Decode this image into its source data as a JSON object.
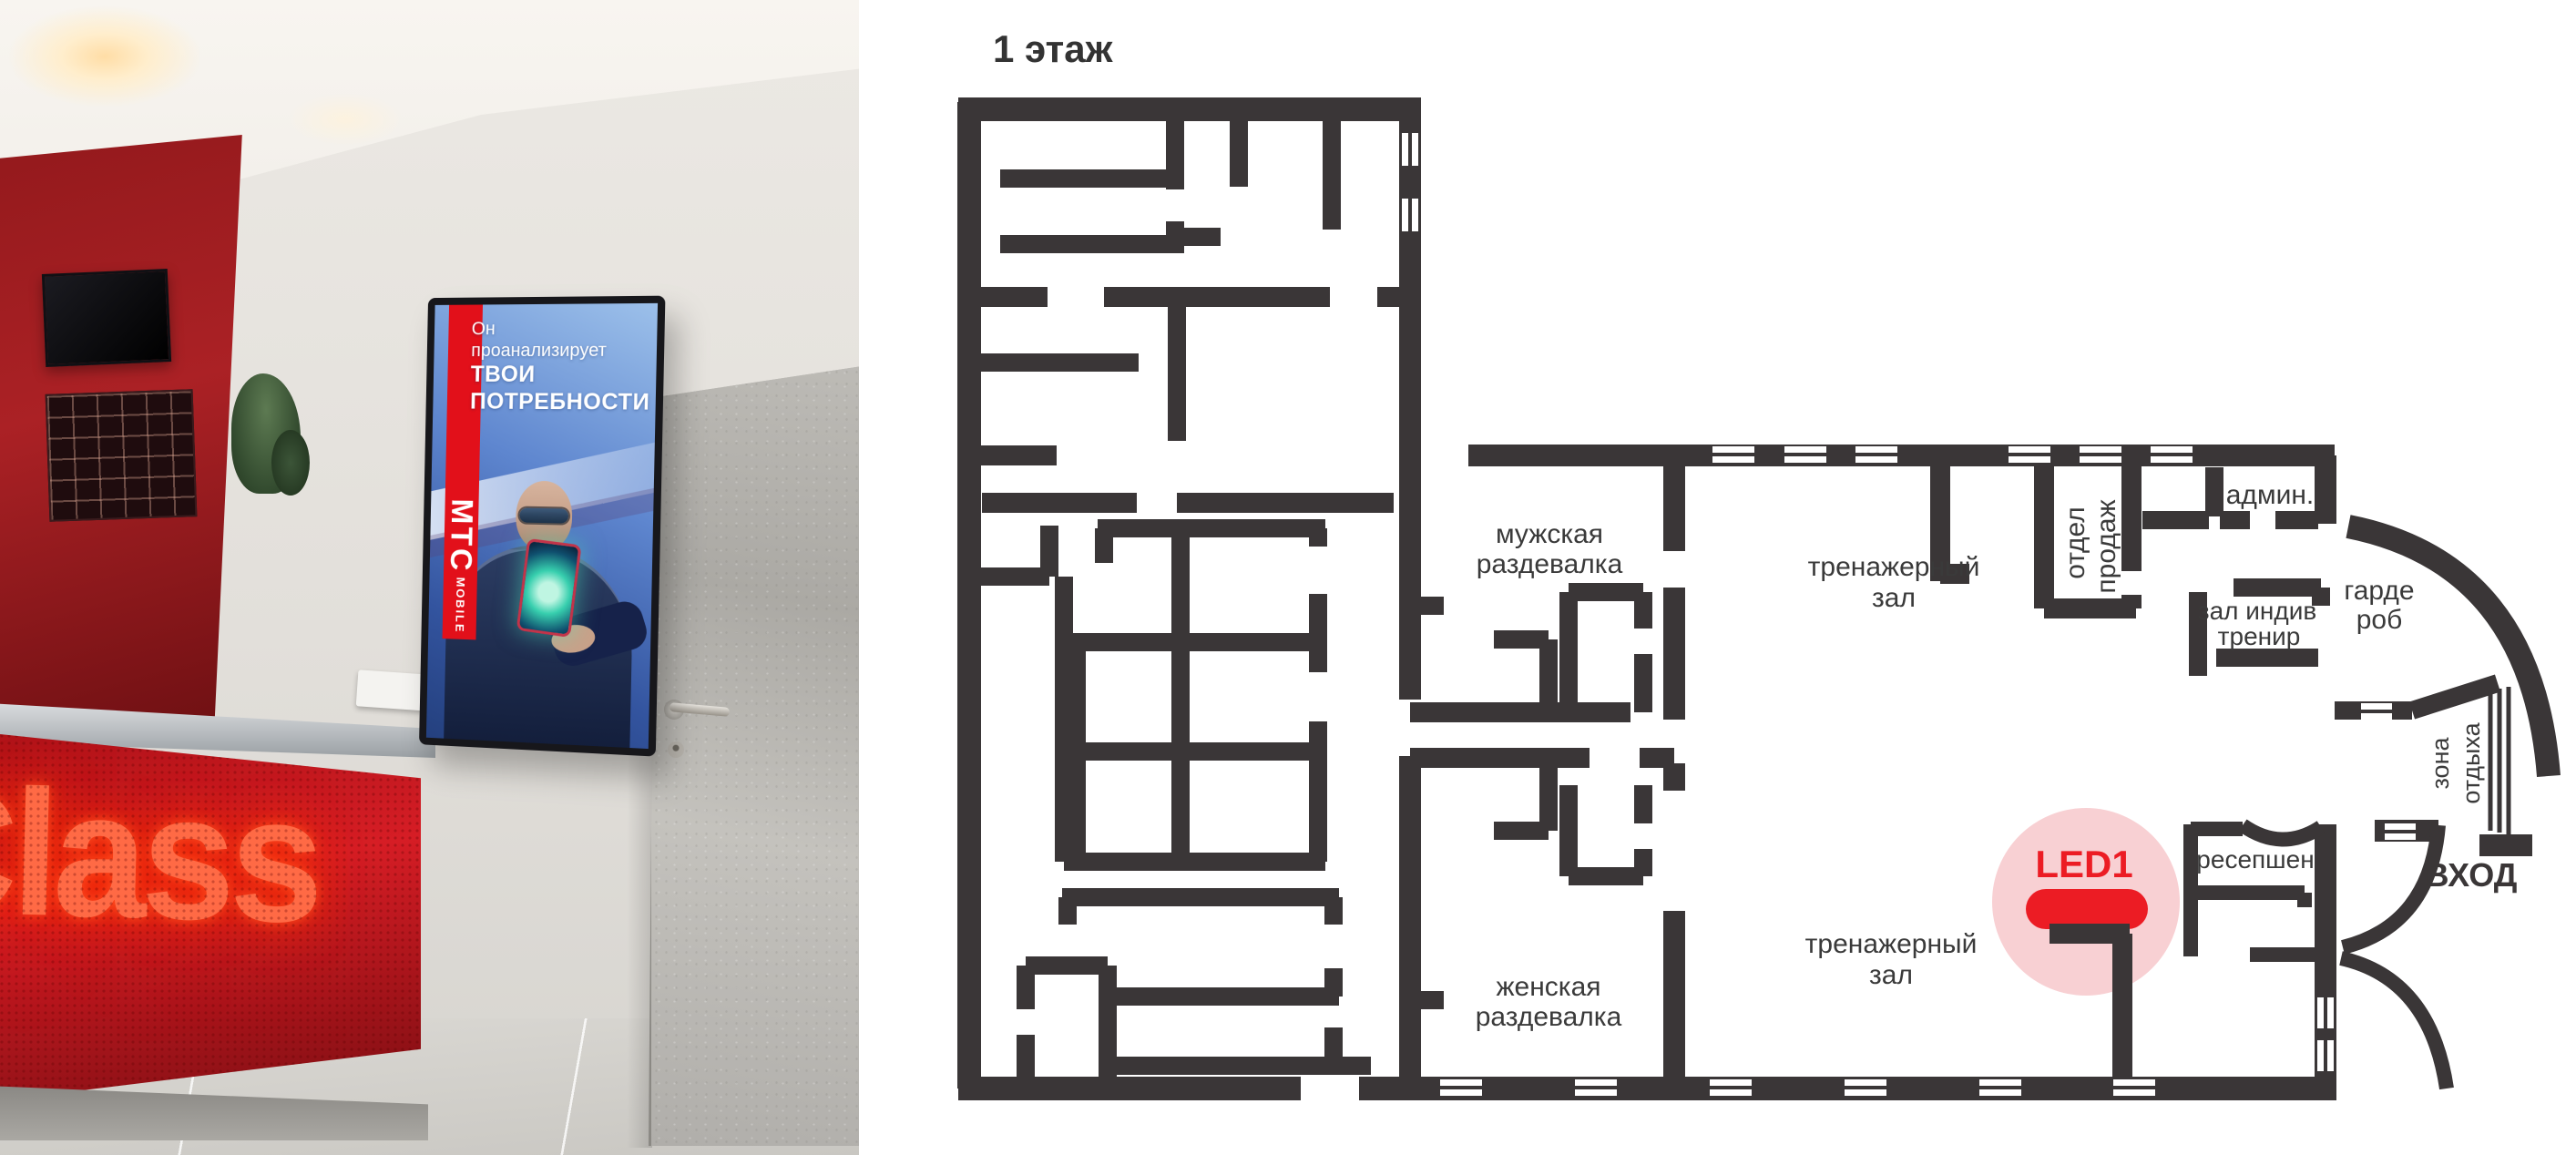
{
  "floorplan": {
    "title": "1 этаж",
    "wall_color": "#3a3637",
    "rooms": {
      "mens_locker": {
        "l1": "мужская",
        "l2": "раздевалка"
      },
      "womens_locker": {
        "l1": "женская",
        "l2": "раздевалка"
      },
      "gym_top": {
        "l1": "тренажерный",
        "l2": "зал"
      },
      "gym_bottom": {
        "l1": "тренажерный",
        "l2": "зал"
      },
      "sales": {
        "l1": "отдел",
        "l2": "продаж"
      },
      "admin": {
        "l1": "админ."
      },
      "individual": {
        "l1": "зал индив",
        "l2": "тренир"
      },
      "wardrobe": {
        "l1": "гарде",
        "l2": "роб"
      },
      "rest_zone": {
        "l1": "зона",
        "l2": "отдыха"
      },
      "reception": {
        "l1": "ресепшен"
      },
      "entrance": {
        "l1": "ВХОД"
      }
    },
    "marker": {
      "label": "LED1",
      "color": "#ec1c24",
      "glow": "#f8d0d3"
    }
  },
  "photo": {
    "desk_sign": "itClass",
    "screen": {
      "ad_line1": "Он",
      "ad_line2": "проанализирует",
      "ad_line3": "ТВОИ",
      "ad_line4": "ПОТРЕБНОСТИ",
      "brand": "МТС",
      "brand_sub": "MOBILE"
    }
  }
}
